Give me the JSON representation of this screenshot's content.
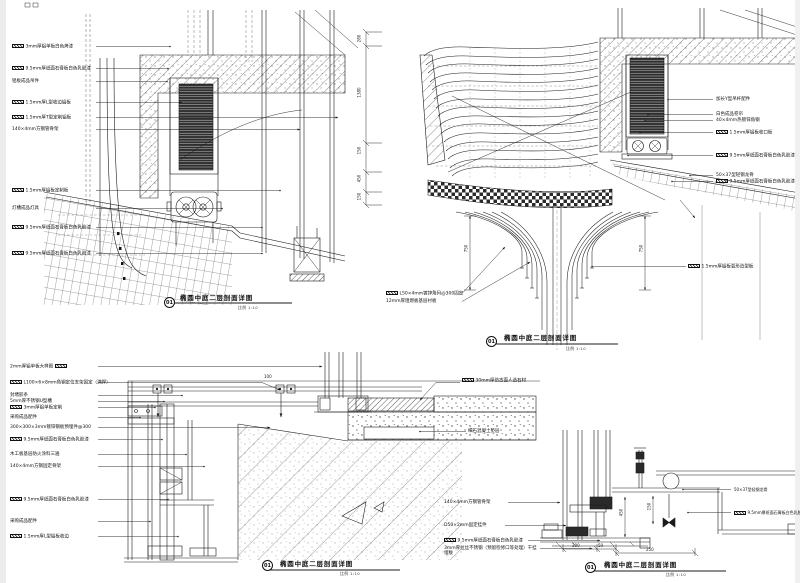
{
  "sheet": {
    "background": "#ffffff",
    "line_color": "#1b1b1b",
    "edge_color": "#ececec"
  },
  "titles": [
    {
      "num": "01",
      "text": "椭圆中庭二层剖面详图",
      "scale": "比例 1:10"
    },
    {
      "num": "01",
      "text": "椭圆中庭二层剖面详图",
      "scale": "比例 1:10"
    },
    {
      "num": "01",
      "text": "椭圆中庭二层剖面详图",
      "scale": "比例 1:10"
    },
    {
      "num": "01",
      "text": "椭圆中庭二层剖面详图",
      "scale": "比例 1:10"
    }
  ],
  "d1": {
    "labels": [
      {
        "text": "3mm厚铝单板白色烤漆"
      },
      {
        "text": "9.5mm厚纸面石膏板白色乳胶漆"
      },
      {
        "text": "铝板成品吊件"
      },
      {
        "text": "1.5mm厚L型收边铝板"
      },
      {
        "text": "1.5mm厚T型定制铝板"
      },
      {
        "text": "140×4mm方钢管骨架"
      },
      {
        "text": "1.5mm厚铝板定制板"
      },
      {
        "text": "灯槽成品灯具"
      },
      {
        "text": "9.5mm厚纸面石膏板白色乳胶漆"
      },
      {
        "text": "9.5mm厚纸面石膏板白色乳胶漆"
      }
    ]
  },
  "d2": {
    "labels_right": [
      {
        "text": "加长Y型吊杆配件"
      },
      {
        "text": "白色成品卷帘"
      },
      {
        "text": "40×4mm热镀锌角钢"
      },
      {
        "text": "1.5mm厚铝板收口板"
      },
      {
        "text": "9.5mm厚纸面石膏板白色乳胶漆"
      },
      {
        "text": "50×37型轻钢龙骨"
      },
      {
        "text": "9.5mm厚纸面石膏板白色乳胶漆"
      }
    ],
    "label_funnel": "1.5mm厚铝板弧形造型板",
    "labels_bottom": [
      "L50×4mm镀锌角码@300固定",
      "12mm厚阻燃板基层衬板"
    ],
    "dims": [
      "280",
      "1380",
      "150",
      "450",
      "150",
      "750",
      "750"
    ]
  },
  "d3": {
    "labels_left": [
      {
        "text": "2mm厚铝单板大样图"
      },
      {
        "text": "L100×6×8mm角钢定位支架固定（满焊）"
      },
      {
        "text": "封堵胶条"
      },
      {
        "text": "5mm厚不锈钢U型槽"
      },
      {
        "text": "3mm厚铝单板定制"
      },
      {
        "text": "采购成品配件"
      },
      {
        "text": "300×300×3mm镀锌钢板预埋件@300"
      },
      {
        "text": "9.5mm厚纸面石膏板白色乳胶漆"
      },
      {
        "text": "木工板基层防火涂料三遍"
      },
      {
        "text": "140×4mm方钢固定骨架"
      },
      {
        "text": "9.5mm厚纸面石膏板白色乳胶漆"
      },
      {
        "text": "采购成品配件"
      },
      {
        "text": "1.5mm厚L型铝板收边"
      }
    ],
    "labels_right": [
      "30mm厚仿古面人造石材",
      "细石混凝土垫层"
    ],
    "labels_mid": [
      "140×4mm方钢管骨架",
      "D50×2mm固定挂件",
      "9.5mm厚纸面石膏板白色乳胶漆",
      "3mm厚拉丝不锈钢（预留检修口等处理）干挂埋板"
    ],
    "dims": [
      "100"
    ]
  },
  "d4": {
    "labels_right": [
      "50×37型轻钢龙骨",
      "9.5mm厚纸面石膏板白色乳胶漆"
    ],
    "dims": [
      "450",
      "150",
      "200",
      "50",
      "250"
    ]
  }
}
